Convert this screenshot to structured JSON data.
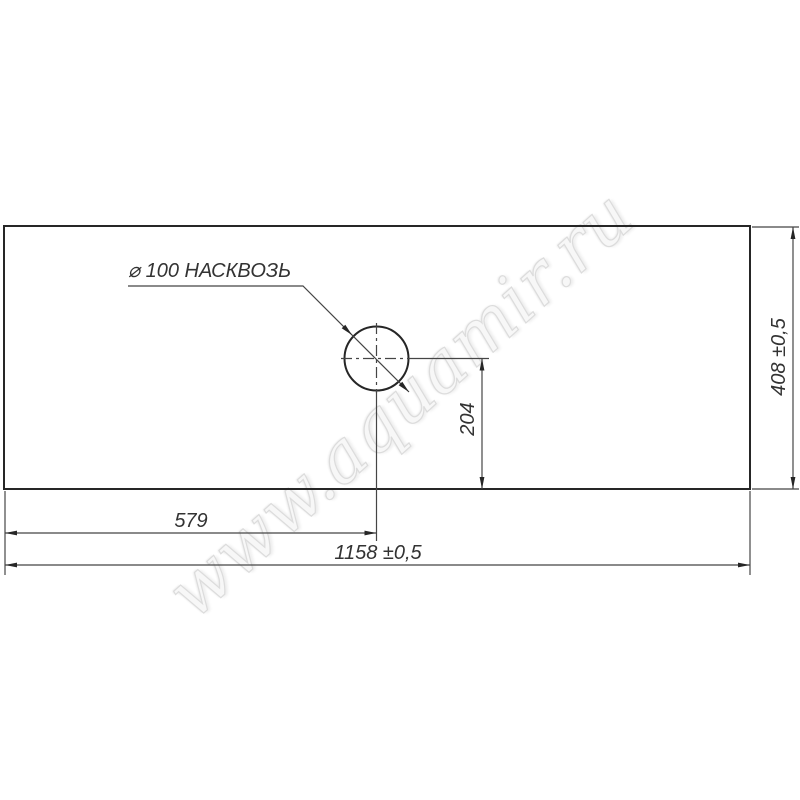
{
  "drawing": {
    "watermark": "www.aquamir.ru",
    "labels": {
      "hole_note": "⌀ 100 НАСКВОЗЬ",
      "dim_width_half": "579",
      "dim_width_total": "1158 ±0,5",
      "dim_hole_offset_y": "204",
      "dim_height_total": "408 ±0,5"
    },
    "colors": {
      "outline": "#262626",
      "dim_lines": "#454545",
      "text": "#333333",
      "watermark_outline": "#dcdcdc",
      "background": "#ffffff"
    }
  }
}
